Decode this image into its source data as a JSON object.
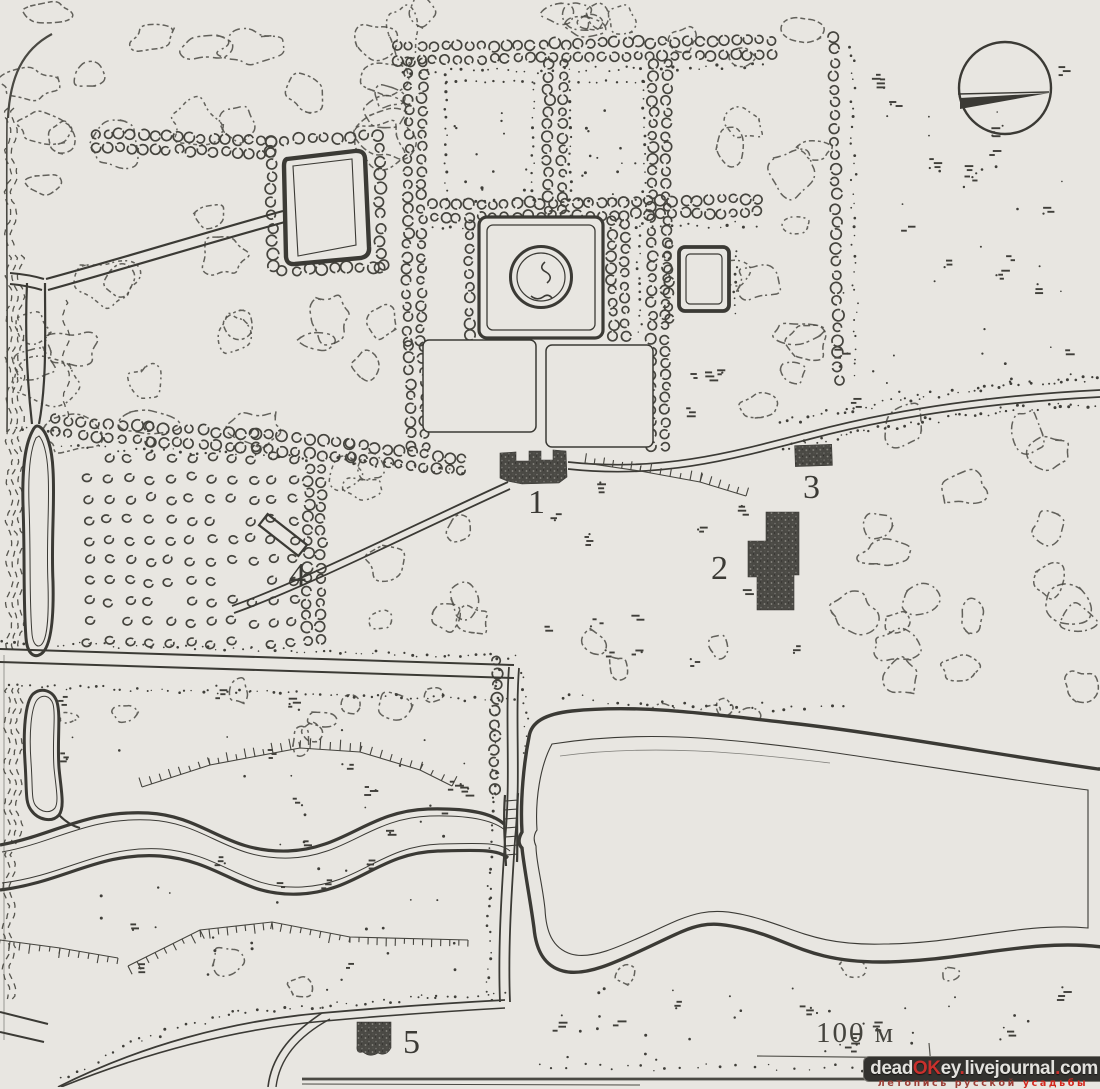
{
  "document": {
    "kind": "scanned estate park plan",
    "language": "ru"
  },
  "map": {
    "markers": [
      {
        "label": "1"
      },
      {
        "label": "2"
      },
      {
        "label": "3"
      },
      {
        "label": "4"
      },
      {
        "label": "5"
      }
    ],
    "scale_label": "100 м",
    "compass_icon": "north-needle"
  },
  "watermark": {
    "bar_segments": [
      {
        "text": "dead",
        "color": "#e3e2de"
      },
      {
        "text": "OK",
        "color": "#c9302c"
      },
      {
        "text": "ey",
        "color": "#e3e2de"
      },
      {
        "text": ".",
        "color": "#c9302c"
      },
      {
        "text": "livejournal",
        "color": "#e3e2de"
      },
      {
        "text": ".",
        "color": "#c9302c"
      },
      {
        "text": "com",
        "color": "#e3e2de"
      }
    ],
    "bar_bg": "#33322f",
    "tagline_main": "летопись русской",
    "tagline_accent": "усадьбы",
    "tagline_main_color": "#9c4038",
    "tagline_accent_color": "#d3281e"
  },
  "colors": {
    "paper": "#e8e6e1",
    "ink": "#3b3a35"
  }
}
